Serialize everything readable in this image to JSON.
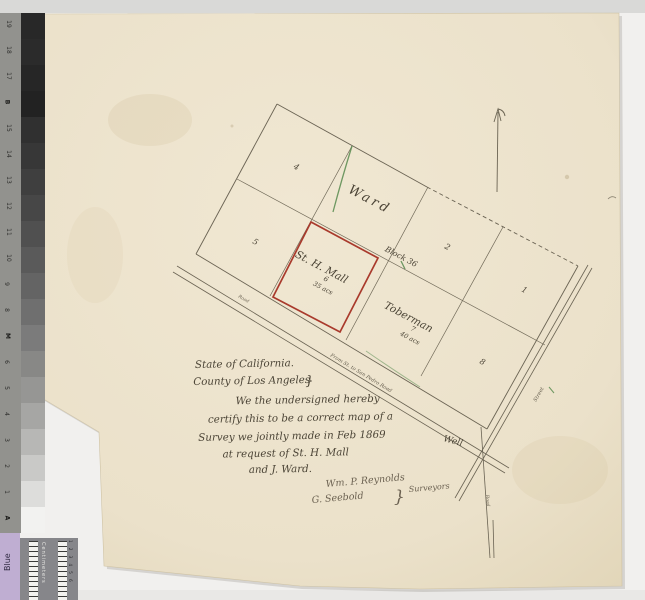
{
  "meta": {
    "description": "Scanned hand-drawn survey map, Los Angeles County, with photographic grayscale calibration strip"
  },
  "calibration": {
    "labels": [
      "19",
      "18",
      "17",
      "B",
      "15",
      "14",
      "13",
      "12",
      "11",
      "10",
      "9",
      "8",
      "M",
      "6",
      "5",
      "4",
      "3",
      "2",
      "1",
      "A"
    ],
    "step_styles": [
      "background:#282828",
      "background:#2b2b2b",
      "background:#262626",
      "background:#222222",
      "background:#303030",
      "background:#373737",
      "background:#3f3f3f",
      "background:#474747",
      "background:#505050",
      "background:#5a5a5a",
      "background:#646464",
      "background:#6f6f6f",
      "background:#7b7b7b",
      "background:#888886",
      "background:#969694",
      "background:#a6a6a4",
      "background:#b7b7b5",
      "background:#c9c9c7",
      "background:#dddddb",
      "background:#f2f2f0"
    ],
    "blue_patch_label": "Blue",
    "ruler": {
      "label": "Centimeters",
      "scale": "1 2 3 4 5 6"
    }
  },
  "map": {
    "parcel_ward": "Ward",
    "block_label": "Block 36",
    "mall": {
      "name": "St. H. Mall",
      "number": "6",
      "area": "35 acs"
    },
    "toberman": {
      "name": "Toberman",
      "number": "7",
      "area": "40 acs"
    },
    "numbers": {
      "p1": "1",
      "p2": "2",
      "p4": "4",
      "p5": "5",
      "p8": "8"
    },
    "well_label": "Well",
    "roads": {
      "nw": "Road",
      "sw": "From St. to San Pedro Road",
      "se": "Street",
      "south": "Road"
    }
  },
  "certificate": {
    "lines": [
      "State of California.",
      "County of Los Angeles",
      "We the undersigned hereby",
      "certify this to be a correct map of a",
      "Survey we jointly made in Feb 1869",
      "at request of St. H. Mall",
      "and J. Ward."
    ],
    "brace": "}",
    "signatures": [
      "Wm. P. Reynolds",
      "G. Seebold"
    ],
    "signature_brace": "}",
    "signature_role": "Surveyors"
  },
  "colors": {
    "paper": "#ece2cb",
    "ink": "#6a6353",
    "parcel_outline_red": "#a93a2c",
    "survey_green": "#578a4e",
    "blue_patch": "#bfaed2"
  }
}
